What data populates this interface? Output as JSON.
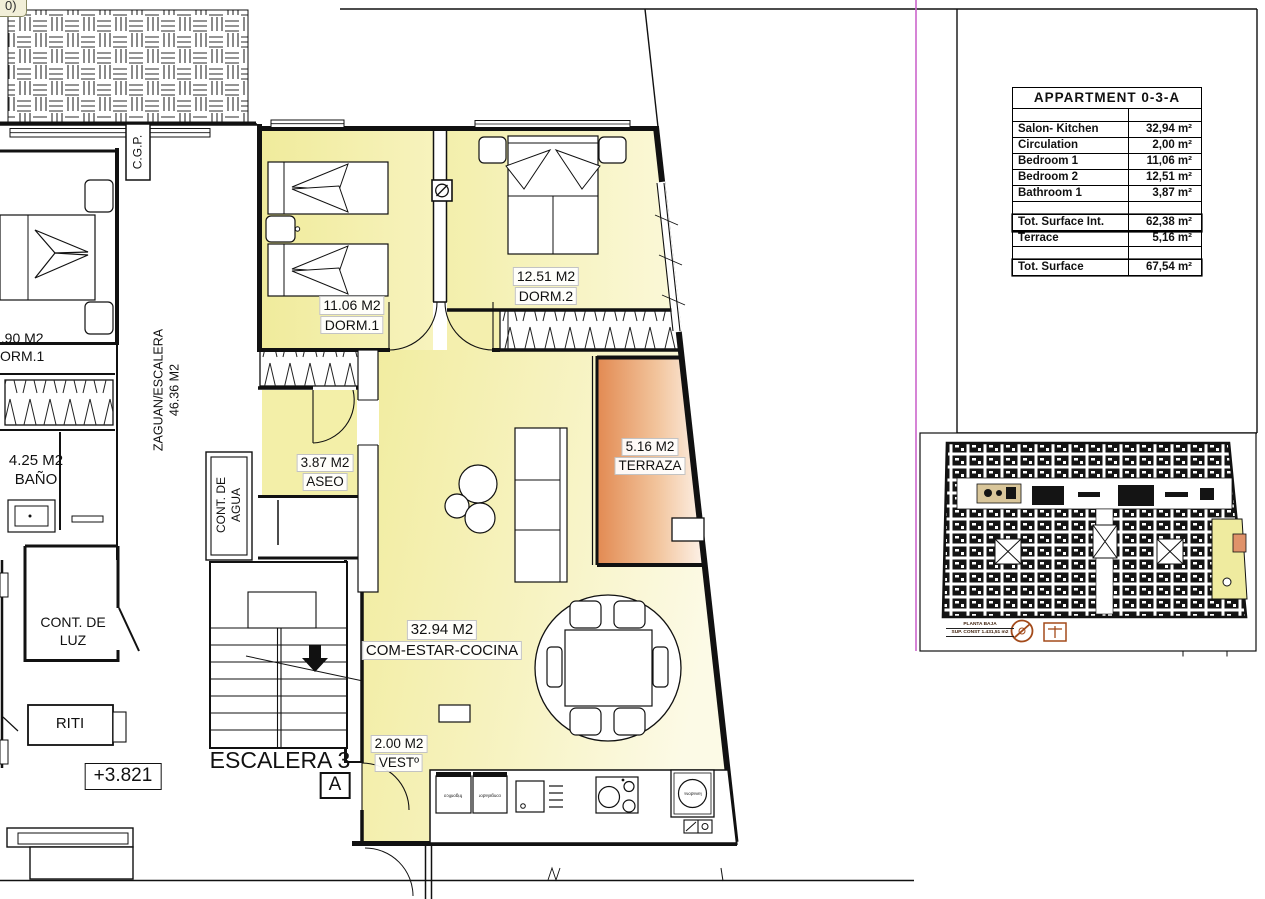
{
  "corner_tag": "0)",
  "plan": {
    "rooms": {
      "dorm1": {
        "area": "11.06 M2",
        "name": "DORM.1"
      },
      "dorm2": {
        "area": "12.51 M2",
        "name": "DORM.2"
      },
      "aseo": {
        "area": "3.87 M2",
        "name": "ASEO"
      },
      "salon": {
        "area": "32.94 M2",
        "name": "COM-ESTAR-COCINA"
      },
      "terraza": {
        "area": "5.16 M2",
        "name": "TERRAZA"
      },
      "vestibulo": {
        "area": "2.00 M2",
        "name": "VESTº"
      },
      "bano_vecino": {
        "area": "4.25 M2",
        "name": "BAÑO"
      },
      "dorm_vecino": {
        "area": ".90 M2",
        "name": "ORM.1"
      }
    },
    "zaguan": {
      "line1": "ZAGUAN/ESCALERA",
      "line2": "46.36 M2"
    },
    "cgp": "C.G.P.",
    "cont_agua": {
      "line1": "CONT. DE",
      "line2": "AGUA"
    },
    "cont_luz": {
      "line1": "CONT. DE",
      "line2": "LUZ"
    },
    "riti": "RITI",
    "level_mark": "+3.821",
    "stair_name": "ESCALERA 3",
    "section_mark": "A",
    "appliances": {
      "fridge": "frigorifico",
      "freezer": "congelador",
      "washer": "lavadora"
    }
  },
  "summary_table": {
    "title": "APPARTMENT 0-3-A",
    "rows": [
      {
        "label": "Salon- Kitchen",
        "value": "32,94 m²"
      },
      {
        "label": "Circulation",
        "value": "2,00 m²"
      },
      {
        "label": "Bedroom 1",
        "value": "11,06 m²"
      },
      {
        "label": "Bedroom 2",
        "value": "12,51 m²"
      },
      {
        "label": "Bathroom 1",
        "value": "3,87 m²"
      }
    ],
    "totals": {
      "interior": {
        "label": "Tot. Surface Int.",
        "value": "62,38 m²"
      },
      "terrace": {
        "label": "Terrace",
        "value": "5,16 m²"
      },
      "total": {
        "label": "Tot. Surface",
        "value": "67,54 m²"
      }
    }
  },
  "minimap": {
    "caption_line1": "PLANTA BAJA",
    "caption_line2": "SUP. CONST 1.431,51 m2"
  },
  "colors": {
    "room_fill": "#f1ec9e",
    "terrace_fill": "#e28a52",
    "frame_magenta": "#cc66cc",
    "minimap_highlight": "#efeb9f"
  }
}
